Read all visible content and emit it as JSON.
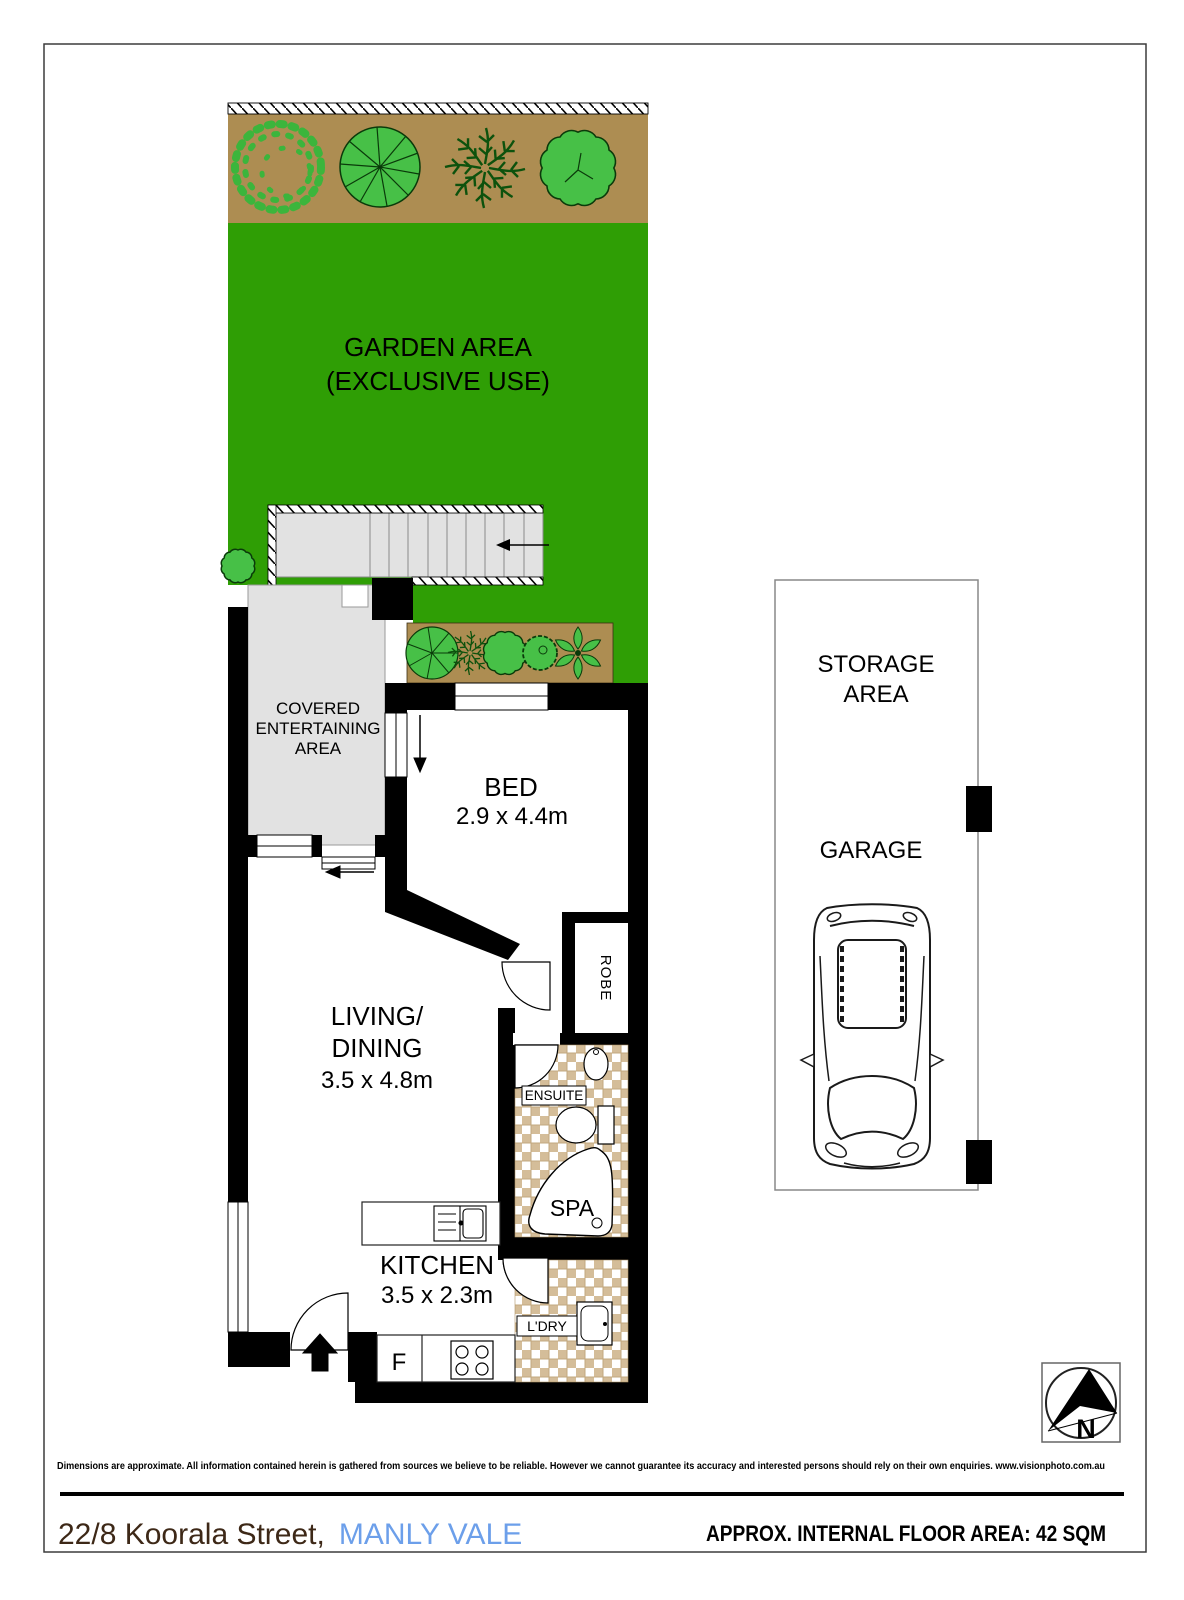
{
  "page": {
    "disclaimer": "Dimensions are approximate. All information contained herein is gathered from sources we believe to be reliable. However we cannot guarantee its accuracy and interested persons should rely on their own enquiries. www.visionphoto.com.au",
    "address_street": "22/8 Koorala Street,",
    "address_suburb": "MANLY VALE",
    "floor_area": "APPROX. INTERNAL FLOOR AREA: 42 SQM"
  },
  "plan": {
    "garden": {
      "line1": "GARDEN AREA",
      "line2": "(EXCLUSIVE USE)"
    },
    "covered": {
      "line1": "COVERED",
      "line2": "ENTERTAINING",
      "line3": "AREA"
    },
    "bed": {
      "label": "BED",
      "dims": "2.9 x 4.4m"
    },
    "living": {
      "line1": "LIVING/",
      "line2": "DINING",
      "dims": "3.5 x 4.8m"
    },
    "kitchen": {
      "label": "KITCHEN",
      "dims": "3.5 x 2.3m"
    },
    "robe": {
      "label": "ROBE"
    },
    "ensuite": {
      "label": "ENSUITE"
    },
    "spa": {
      "label": "SPA"
    },
    "laundry": {
      "label": "L'DRY"
    },
    "fridge": {
      "label": "F"
    },
    "storage": {
      "line1": "STORAGE",
      "line2": "AREA"
    },
    "garage": {
      "label": "GARAGE"
    },
    "compass": {
      "label": "N"
    }
  },
  "colors": {
    "garden_green": "#2f9e05",
    "soil_brown": "#ad8d52",
    "plant_green": "#47c047",
    "plant_outline": "#0a3a0a",
    "paving_gray": "#e2e2e2",
    "tile_fill": "#d4bd99",
    "tile_line": "#c2a87f",
    "suburb_blue": "#6c9fea",
    "street_brown": "#3d2817"
  }
}
